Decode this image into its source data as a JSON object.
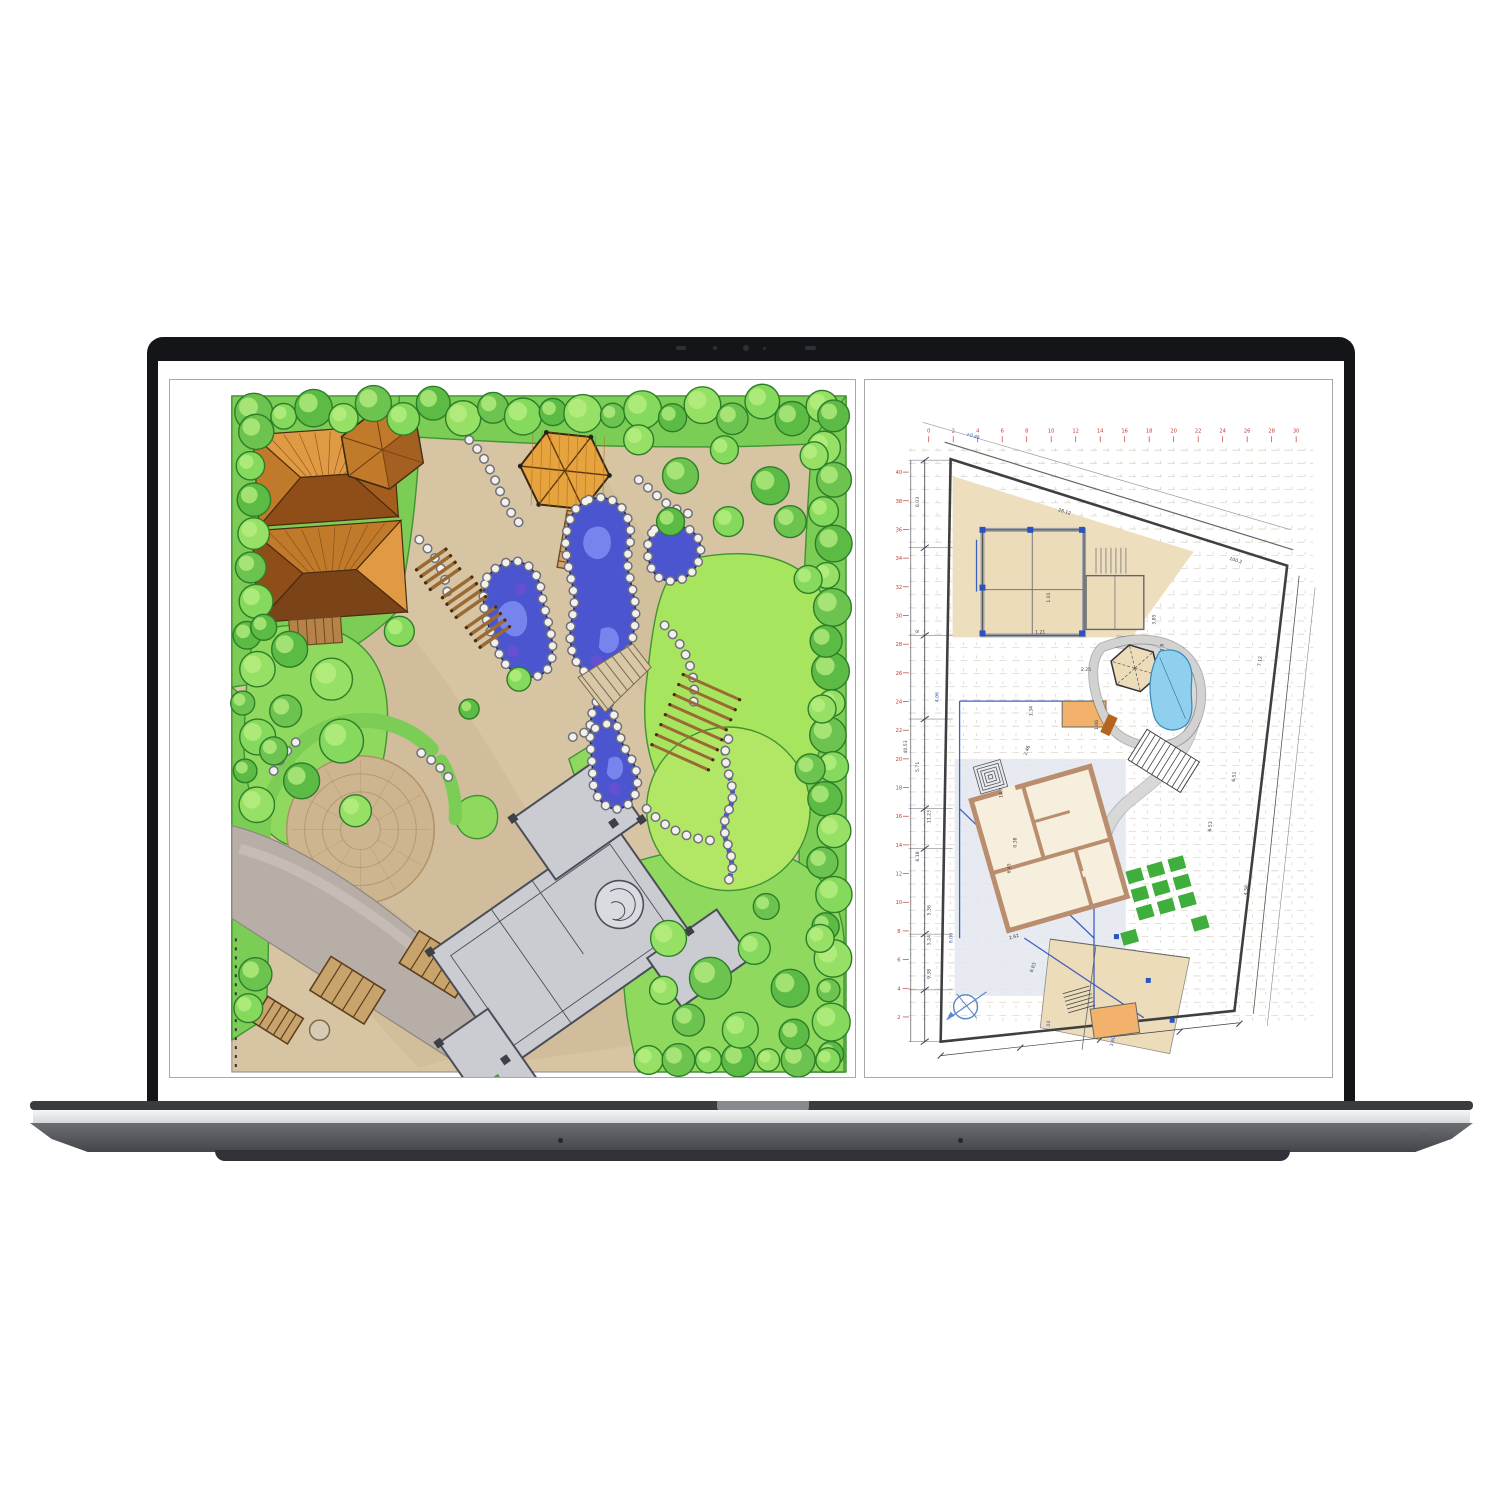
{
  "device": {
    "kind": "laptop",
    "webcam_icon": "camera-dot-array",
    "colors": {
      "bezel": "#141519",
      "base_silver": "#e9eaec",
      "base_body": "#55585d",
      "base_lip": "#303237",
      "hinge": "#86898e"
    }
  },
  "display": {
    "background": "#ffffff",
    "panel_border": "#a8a8a8",
    "left_panel": {
      "name": "hand-drawn-landscape-plan",
      "colors": {
        "ground": "#d7c4a2",
        "ground_dark": "#c3ac87",
        "green": "#7ccd55",
        "green_mid": "#8fd95f",
        "green_light": "#a8e55f",
        "green_line": "#3f9333",
        "tree": "#6cc34f",
        "tree_hi": "#b9ef83",
        "tree_line": "#2e7d28",
        "water": "#4a55cf",
        "water_hi": "#7d8af0",
        "water_purple": "#6a4fd0",
        "water_line": "#23246e",
        "rock": "#f2f1ee",
        "rock_line": "#70707a",
        "roof_light": "#e09a43",
        "roof_mid": "#c07a2a",
        "roof_dark": "#8f4d17",
        "wood": "#9a6a33",
        "bridge": "#cfa56b",
        "road": "#b7afa7",
        "plaza": "#cdb68f",
        "plaza_line": "#b0916a",
        "house": "#caccd2",
        "house_line": "#4a4e58"
      }
    },
    "right_panel": {
      "name": "cad-site-plan",
      "colors": {
        "paper": "#ffffff",
        "grid": "#ddd5c8",
        "red": "#c23b32",
        "dim": "#3a3f4a",
        "blue": "#2a52c0",
        "beige": "#ecdcba",
        "orange": "#f2b26b",
        "green": "#3fae3c",
        "pool": "#8fd0ef",
        "pool_line": "#3a87b8",
        "wall": "#b98d6e",
        "pave": "#d8d8d8",
        "boundary": "#3f3f3f",
        "terrace": "#e3e7ee"
      },
      "grid_labels_top": [
        "0",
        "2",
        "4",
        "6",
        "8",
        "10",
        "12",
        "14",
        "16",
        "18",
        "20",
        "22",
        "24",
        "26",
        "28",
        "30"
      ],
      "grid_labels_left": [
        "40",
        "38",
        "36",
        "34",
        "32",
        "30",
        "28",
        "26",
        "24",
        "22",
        "20",
        "18",
        "16",
        "14",
        "12",
        "10",
        "8",
        "6",
        "4",
        "2"
      ],
      "dim_labels": [
        {
          "t": "28.12",
          "x": 200,
          "y": 133,
          "r": 17
        },
        {
          "t": "100.2",
          "x": 372,
          "y": 182,
          "r": 17
        },
        {
          "t": "6.03",
          "x": 54,
          "y": 122,
          "r": -90
        },
        {
          "t": "8",
          "x": 54,
          "y": 252,
          "r": -90
        },
        {
          "t": "5.71",
          "x": 54,
          "y": 388,
          "r": -90
        },
        {
          "t": "40.53",
          "x": 42,
          "y": 368,
          "r": -90
        },
        {
          "t": "6.18",
          "x": 54,
          "y": 478,
          "r": -90
        },
        {
          "t": "11.23",
          "x": 66,
          "y": 438,
          "r": -90
        },
        {
          "t": "5.36",
          "x": 66,
          "y": 532,
          "r": -90
        },
        {
          "t": "5.24",
          "x": 66,
          "y": 562,
          "r": -90
        },
        {
          "t": "9.38",
          "x": 66,
          "y": 596,
          "r": -90
        },
        {
          "t": "14.7",
          "x": 138,
          "y": 414,
          "r": -90
        },
        {
          "t": "6.45",
          "x": 146,
          "y": 490,
          "r": -90
        },
        {
          "t": "0.38",
          "x": 152,
          "y": 464,
          "r": -90
        },
        {
          "t": "1.01",
          "x": 186,
          "y": 218,
          "r": -90
        },
        {
          "t": "1.21",
          "x": 176,
          "y": 254,
          "r": 0
        },
        {
          "t": "1.34",
          "x": 168,
          "y": 332,
          "r": -90
        },
        {
          "t": "2.46",
          "x": 164,
          "y": 372,
          "r": -70
        },
        {
          "t": "2.25",
          "x": 222,
          "y": 292,
          "r": 0
        },
        {
          "t": "1.06",
          "x": 234,
          "y": 346,
          "r": -90
        },
        {
          "t": "3.85",
          "x": 292,
          "y": 240,
          "r": -90
        },
        {
          "t": "1.8",
          "x": 300,
          "y": 268,
          "r": -90
        },
        {
          "t": "7.12",
          "x": 398,
          "y": 282,
          "r": -84
        },
        {
          "t": "6.51",
          "x": 372,
          "y": 398,
          "r": -84
        },
        {
          "t": "4.58",
          "x": 384,
          "y": 512,
          "r": -84
        },
        {
          "t": "6.53",
          "x": 348,
          "y": 448,
          "r": -84
        },
        {
          "t": "2.62",
          "x": 150,
          "y": 560,
          "r": -16
        },
        {
          "t": "8.83",
          "x": 170,
          "y": 590,
          "r": -70
        }
      ],
      "blue_labels": [
        {
          "t": "4.06",
          "x": 74,
          "y": 318,
          "r": -90
        },
        {
          "t": "0.00",
          "x": 88,
          "y": 560,
          "r": -90
        },
        {
          "t": "3.60",
          "x": 250,
          "y": 664,
          "r": -75
        },
        {
          "t": "1.04",
          "x": 186,
          "y": 648,
          "r": -90
        },
        {
          "t": "+0.45",
          "x": 108,
          "y": 57,
          "r": 17
        }
      ]
    }
  }
}
